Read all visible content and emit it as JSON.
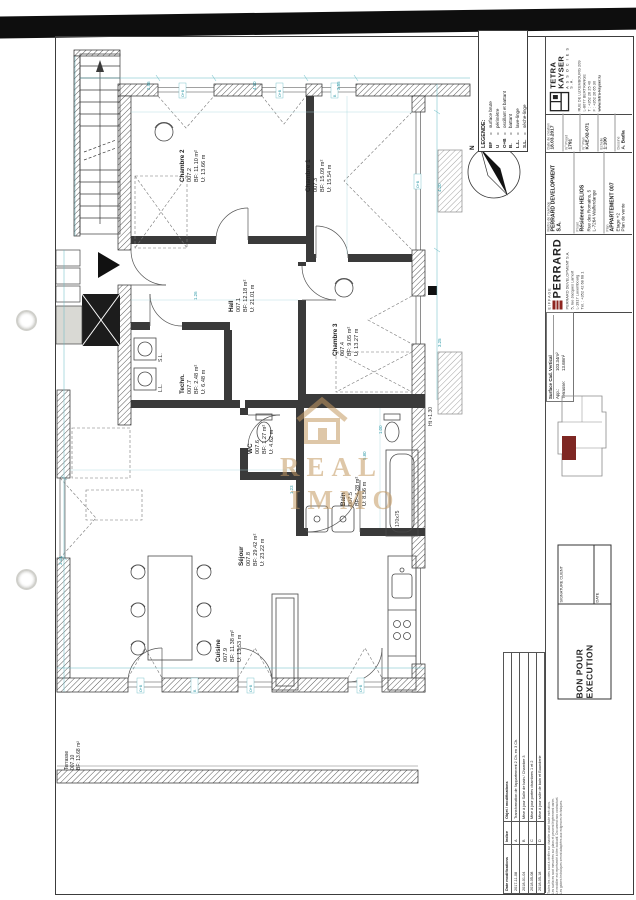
{
  "legend": {
    "title": "LEGENDE:",
    "items": [
      {
        "abbr": "BF",
        "eq": "=",
        "def": "surface brute"
      },
      {
        "abbr": "U",
        "eq": "=",
        "def": "périmètre"
      },
      {
        "abbr": "O+B",
        "eq": "=",
        "def": "oscillant et battant"
      },
      {
        "abbr": "B.",
        "eq": "=",
        "def": "battant"
      },
      {
        "abbr": "L.L.",
        "eq": "=",
        "def": "lave-linge"
      },
      {
        "abbr": "S.L.",
        "eq": "=",
        "def": "sèche-linge"
      }
    ]
  },
  "compass": {
    "north": "N"
  },
  "plan": {
    "rooms": [
      {
        "name": "Chambre 2",
        "num": "007.2",
        "bf": "BF: 11.10 m²",
        "u": "U: 13.66 m"
      },
      {
        "name": "Chambre 1",
        "num": "007.3",
        "bf": "BF: 15.09 m²",
        "u": "U: 15.54 m"
      },
      {
        "name": "Hall",
        "num": "007.1",
        "bf": "BF: 12.18 m²",
        "u": "U: 21.01 m"
      },
      {
        "name": "Chambre 3",
        "num": "007.4",
        "bf": "BF: 9.05 m²",
        "u": "U: 13.27 m"
      },
      {
        "name": "Bain",
        "num": "007.5",
        "bf": "BF: 4.28 m²",
        "u": "U: 8.56 m"
      },
      {
        "name": "WC",
        "num": "007.6",
        "bf": "BF: 1.27 m²",
        "u": "U: 4.62 m"
      },
      {
        "name": "Techn.",
        "num": "007.7",
        "bf": "BF: 2.48 m²",
        "u": "U: 6.48 m"
      },
      {
        "name": "Séjour",
        "num": "007.8",
        "bf": "BF: 29.42 m²",
        "u": "U: 23.22 m"
      },
      {
        "name": "Cuisine",
        "num": "007.9",
        "bf": "BF: 11.38 m²",
        "u": "U: 13.53 m"
      },
      {
        "name": "Terrasse",
        "num": "007.10",
        "bf": "BF: 13.68 m²",
        "u": ""
      }
    ],
    "annotations": {
      "sl": "S.L.",
      "ll": "L.L.",
      "height_note": "Ht +1.30",
      "tub_size": "170x75"
    },
    "window_tags": [
      "O+B",
      "O+B",
      "B",
      "O+B",
      "O+B",
      "B",
      "O+B",
      "O+B"
    ],
    "dims": [
      "2.96",
      "4.20",
      "3.55",
      "4.20",
      "3.25",
      "1.26",
      "5.80",
      "1.00",
      "3.44",
      "1.23"
    ]
  },
  "watermark": {
    "line1": "REAL",
    "line2": "IMMO"
  },
  "titleblock": {
    "architect": {
      "name": "TETRA KAYSER",
      "sub": "A S S O C I E S   S.A.",
      "addr1": "RUE DE LUXEMBOURG 209",
      "addr2": "L-8077 BERTRANGE",
      "tel": "T : +352 26 25 40",
      "fax": "F : +352 26 65 30",
      "web": "www.tetra-kayser.lu"
    },
    "fields": [
      {
        "label": "Date de création",
        "value": "18.03.2017"
      },
      {
        "label": "N° Projet",
        "value": "1791"
      },
      {
        "label": "N° Plan",
        "value": "KAE-02-071"
      },
      {
        "label": "Echelle",
        "value": "1:100"
      },
      {
        "label": "Dessiné",
        "value": "A. Badia"
      }
    ],
    "project": {
      "maitre_label": "Maître de l'ouvrage",
      "maitre": "PERRARD DEVELOPMENT S.A.",
      "projet_label": "Projet",
      "projet1": "Résidence HELIOS",
      "projet2": "Rue des Romains, 5",
      "projet3": "L-7264 Walferdange",
      "plan_label": "Plan",
      "plan1": "APPARTEMENT 007",
      "plan2": "Etage +2",
      "plan3": "Plan de vente"
    },
    "contractor": {
      "group": "EIFFAGE",
      "name": "PERRARD",
      "addr1": "PERRARD DEVELOPMENT S.A.",
      "addr2": "5, rue Jacques Lamort",
      "addr3": "L-1917 Luxembourg",
      "addr4": "Tél. : +352 42 68 68 1"
    },
    "surfaces": {
      "title": "Surface Cad. Vertical",
      "rows": [
        {
          "label": "App.:",
          "value": "103.34m²"
        },
        {
          "label": "Terrasse:",
          "value": "13.68m²"
        }
      ]
    },
    "execution": {
      "title": "BON POUR EXECUTION",
      "date_label": "DATE",
      "signature_label": "SIGNATURE CLIENT"
    },
    "revisions": {
      "headers": [
        "Date modifications",
        "Indice",
        "Objet / modifications"
      ],
      "rows": [
        [
          "2017-11-08",
          "A",
          "Transformation de l'appartement 2 Ch. en 3 Ch."
        ],
        [
          "2018-01-04",
          "B",
          "Mise à jour Salle de bain / Chambre 3"
        ],
        [
          "2018-05-08",
          "C",
          "Mise à jour portes chambres 1 et 2"
        ],
        [
          "2018-05-18",
          "D",
          "Mise à jour salle de bain et Buanderie"
        ]
      ]
    },
    "notes": [
      "Toutes les cotes sont à vérifier sur chantier avant toute exécution.",
      "Les surfaces sont mesurées sur plans et peuvent légèrement varier.",
      "Le mobilier est représenté à titre indicatif. Document non contractuel.",
      "Les gaines techniques seront adaptées aux exigences techniques."
    ]
  }
}
